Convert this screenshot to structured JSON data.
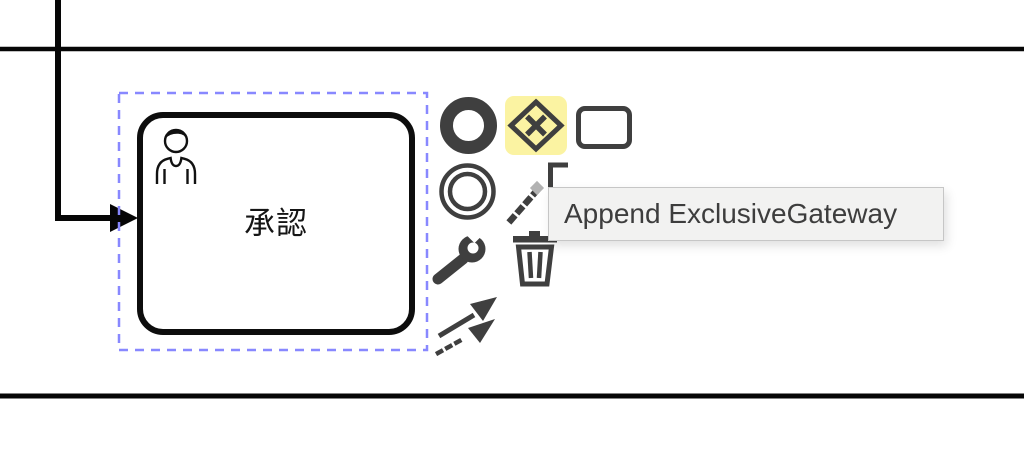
{
  "colors": {
    "selection_outline": "#8888ff",
    "hover_highlight": "#fbf3a2",
    "pad_icon": "#3f3f3f",
    "shape_stroke": "#0d0d0d",
    "tooltip_bg": "#f2f2f1",
    "tooltip_border": "#c6c6c6",
    "tooltip_text_color": "#3d3d3d"
  },
  "task": {
    "label": "承認",
    "type": "user-task",
    "type_icon": "user-icon",
    "selected": true
  },
  "tooltip": {
    "text": "Append ExclusiveGateway"
  },
  "context_pad": {
    "entries": [
      {
        "id": "append-end-event",
        "icon": "end-event-icon",
        "highlighted": false
      },
      {
        "id": "append-exclusive-gateway",
        "icon": "exclusive-gateway-icon",
        "highlighted": true
      },
      {
        "id": "append-task",
        "icon": "task-icon",
        "highlighted": false
      },
      {
        "id": "append-intermediate-event",
        "icon": "intermediate-event-icon",
        "highlighted": false
      },
      {
        "id": "append-text-annotation",
        "icon": "text-annotation-icon",
        "highlighted": false
      },
      {
        "id": "replace-element",
        "icon": "wrench-icon",
        "highlighted": false
      },
      {
        "id": "delete-element",
        "icon": "trash-icon",
        "highlighted": false
      },
      {
        "id": "connect-element",
        "icon": "connection-arrows-icon",
        "highlighted": false
      }
    ]
  }
}
